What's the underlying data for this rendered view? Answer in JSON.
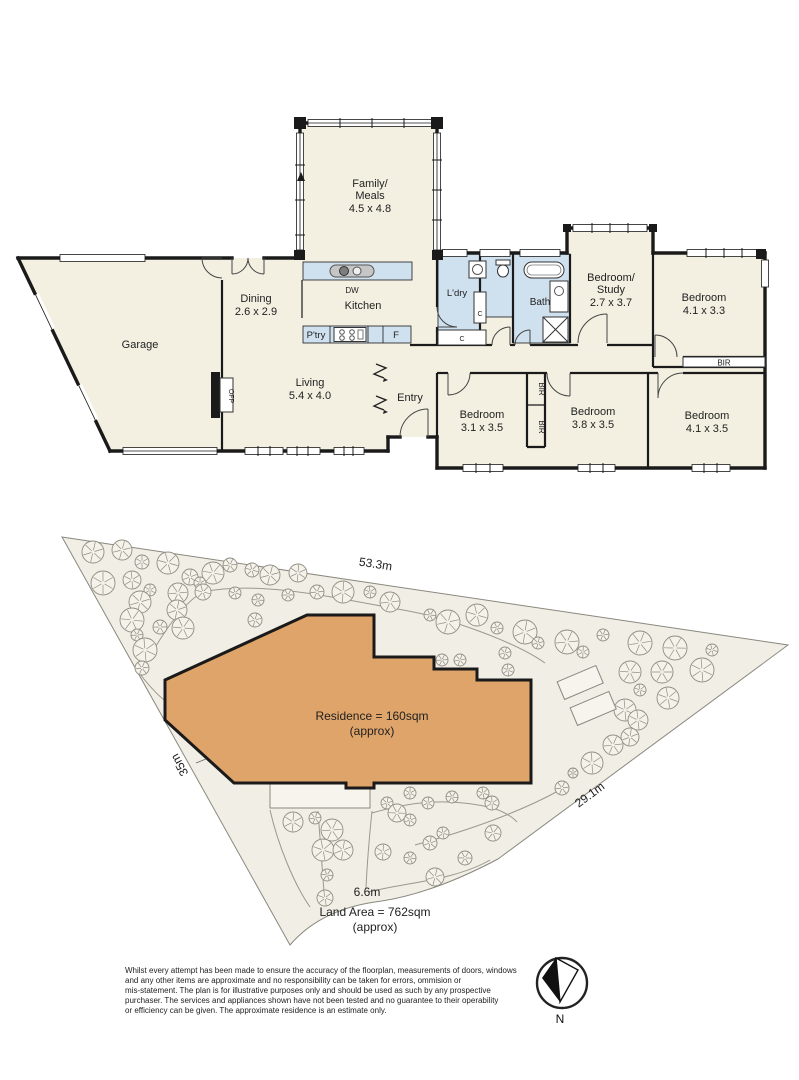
{
  "colors": {
    "floor": "#f3f0e2",
    "wet_area": "#cfe0ee",
    "wall": "#1a1a1a",
    "residence": "#dfa46a",
    "ground": "#f1eee5",
    "tree_stroke": "#8f8d84"
  },
  "floor_plan": {
    "rooms": {
      "family": {
        "line1": "Family/",
        "line2": "Meals",
        "dims": "4.5 x 4.8"
      },
      "dining": {
        "name": "Dining",
        "dims": "2.6 x 2.9"
      },
      "kitchen": {
        "name": "Kitchen"
      },
      "garage": {
        "name": "Garage"
      },
      "living": {
        "name": "Living",
        "dims": "5.4 x 4.0"
      },
      "entry": {
        "name": "Entry"
      },
      "laundry": {
        "name": "L'dry"
      },
      "bath": {
        "name": "Bath"
      },
      "study": {
        "line1": "Bedroom/",
        "line2": "Study",
        "dims": "2.7 x 3.7"
      },
      "bed_top": {
        "name": "Bedroom",
        "dims": "4.1 x 3.3"
      },
      "bed1": {
        "name": "Bedroom",
        "dims": "3.1 x 3.5"
      },
      "bed2": {
        "name": "Bedroom",
        "dims": "3.8 x 3.5"
      },
      "bed3": {
        "name": "Bedroom",
        "dims": "4.1 x 3.5"
      }
    },
    "fixtures": {
      "dw": "DW",
      "pantry": "P'try",
      "fridge": "F",
      "cupboard1": "C",
      "cupboard2": "C",
      "ofp": "OFP",
      "bir_top": "BIR",
      "bir_mid1": "BIR",
      "bir_mid2": "BIR"
    }
  },
  "site_plan": {
    "residence_line1": "Residence = 160sqm",
    "residence_line2": "(approx)",
    "land_line1": "Land Area = 762sqm",
    "land_line2": "(approx)",
    "dim_top": "53.3m",
    "dim_right": "29.1m",
    "dim_bottom": "6.6m",
    "dim_left": "35m",
    "trees": [
      [
        93,
        22,
        11
      ],
      [
        122,
        20,
        10
      ],
      [
        142,
        32,
        7
      ],
      [
        168,
        33,
        11
      ],
      [
        103,
        53,
        12
      ],
      [
        132,
        50,
        9
      ],
      [
        150,
        60,
        6
      ],
      [
        190,
        47,
        8
      ],
      [
        178,
        63,
        10
      ],
      [
        213,
        43,
        11
      ],
      [
        230,
        35,
        7
      ],
      [
        252,
        40,
        7
      ],
      [
        200,
        53,
        6
      ],
      [
        235,
        63,
        6
      ],
      [
        258,
        70,
        6
      ],
      [
        270,
        45,
        10
      ],
      [
        298,
        43,
        9
      ],
      [
        288,
        65,
        6
      ],
      [
        317,
        62,
        7
      ],
      [
        343,
        62,
        11
      ],
      [
        370,
        62,
        6
      ],
      [
        390,
        72,
        10
      ],
      [
        140,
        72,
        11
      ],
      [
        132,
        90,
        12
      ],
      [
        160,
        97,
        7
      ],
      [
        177,
        80,
        10
      ],
      [
        183,
        98,
        11
      ],
      [
        137,
        105,
        6
      ],
      [
        145,
        120,
        12
      ],
      [
        142,
        138,
        7
      ],
      [
        297,
        107,
        12
      ],
      [
        277,
        143,
        6
      ],
      [
        430,
        85,
        6
      ],
      [
        448,
        92,
        12
      ],
      [
        477,
        85,
        11
      ],
      [
        497,
        98,
        6
      ],
      [
        525,
        102,
        12
      ],
      [
        538,
        113,
        6
      ],
      [
        567,
        112,
        12
      ],
      [
        583,
        122,
        6
      ],
      [
        603,
        105,
        6
      ],
      [
        640,
        113,
        12
      ],
      [
        675,
        118,
        12
      ],
      [
        712,
        120,
        6
      ],
      [
        630,
        142,
        11
      ],
      [
        662,
        142,
        11
      ],
      [
        702,
        140,
        12
      ],
      [
        640,
        160,
        6
      ],
      [
        668,
        168,
        11
      ],
      [
        625,
        180,
        11
      ],
      [
        638,
        190,
        10
      ],
      [
        630,
        207,
        9
      ],
      [
        613,
        215,
        10
      ],
      [
        592,
        233,
        11
      ],
      [
        573,
        243,
        5
      ],
      [
        562,
        258,
        7
      ],
      [
        442,
        130,
        6
      ],
      [
        460,
        130,
        6
      ],
      [
        505,
        123,
        6
      ],
      [
        508,
        140,
        6
      ],
      [
        293,
        292,
        10
      ],
      [
        332,
        300,
        11
      ],
      [
        315,
        288,
        6
      ],
      [
        323,
        320,
        11
      ],
      [
        343,
        320,
        10
      ],
      [
        327,
        345,
        6
      ],
      [
        325,
        368,
        8
      ],
      [
        410,
        263,
        6
      ],
      [
        428,
        273,
        6
      ],
      [
        387,
        273,
        6
      ],
      [
        397,
        283,
        9
      ],
      [
        410,
        290,
        6
      ],
      [
        452,
        267,
        6
      ],
      [
        483,
        263,
        6
      ],
      [
        492,
        273,
        7
      ],
      [
        443,
        303,
        6
      ],
      [
        430,
        313,
        7
      ],
      [
        383,
        322,
        8
      ],
      [
        410,
        328,
        6
      ],
      [
        435,
        347,
        9
      ],
      [
        465,
        328,
        7
      ],
      [
        493,
        303,
        8
      ],
      [
        203,
        62,
        8
      ],
      [
        255,
        90,
        7
      ],
      [
        240,
        143,
        7
      ]
    ]
  },
  "compass": {
    "label": "N"
  },
  "disclaimer": {
    "lines": [
      "Whilst every attempt has been made to ensure the accuracy of the floorplan, measurements of doors, windows",
      "and any other items are approximate and no responsibility can be taken for errors, ommision or",
      "mis-statement. The plan is for illustrative purposes only and should be used as such by any prospective",
      "purchaser. The services and appliances shown have not been tested and no guarantee to their operability",
      "or efficiency can be given. The approximate residence is an estimate only."
    ]
  }
}
